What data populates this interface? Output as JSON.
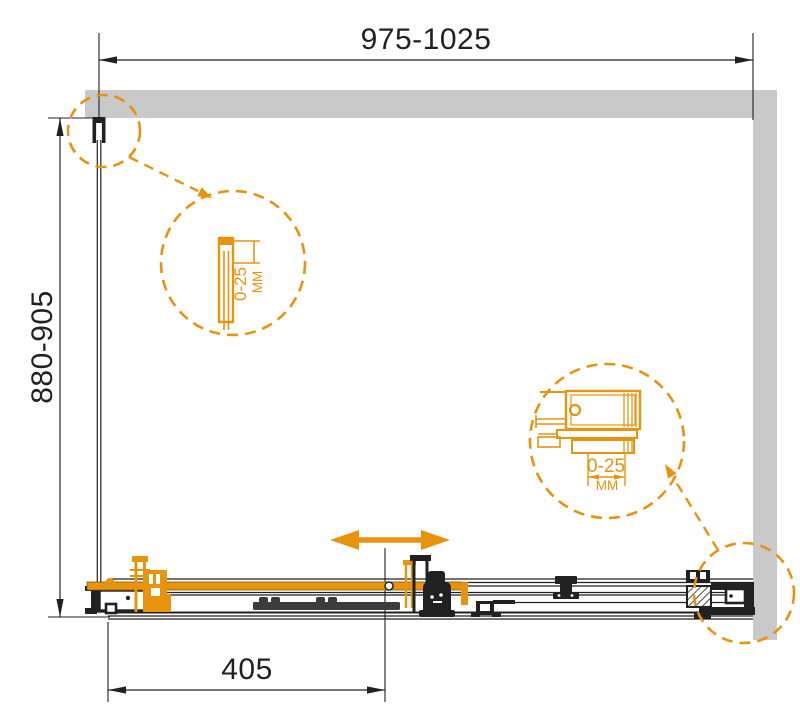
{
  "title": "Shower enclosure installation diagram (top view)",
  "dimensions": {
    "width_label": "975-1025",
    "depth_label": "880-905",
    "door_label": "405"
  },
  "callouts": {
    "left": {
      "value": "0-25",
      "unit": "MM"
    },
    "right": {
      "value": "0-25",
      "unit": "MM"
    }
  },
  "icons": {
    "slide_direction": "double-arrow-horizontal",
    "callout_style": "dashed-magnifier-circle"
  },
  "theme": {
    "accent": "#E8930E",
    "wall": "#C9C9C9",
    "line": "#212121",
    "door": "#3C3C3C",
    "bg": "#FFFFFF"
  }
}
